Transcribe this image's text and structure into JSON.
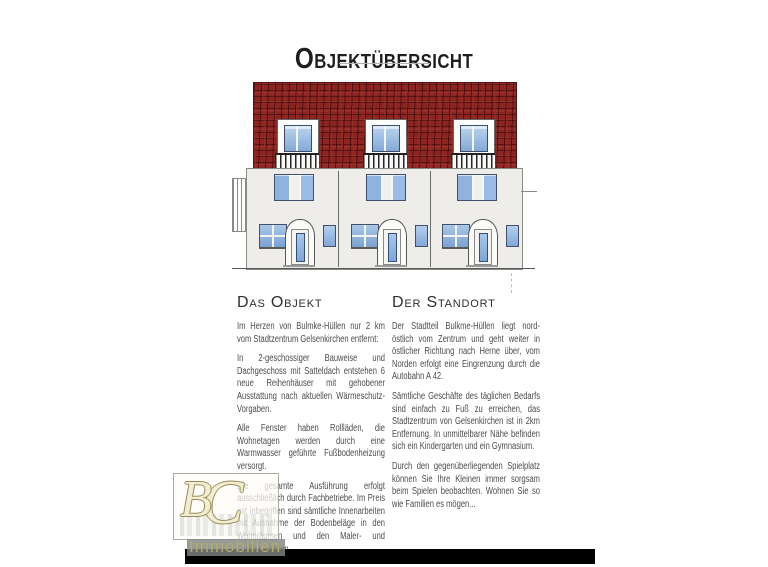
{
  "page": {
    "title": "Objektübersicht"
  },
  "object_section": {
    "heading": "Das Objekt",
    "paragraphs": [
      "Im Herzen von Bulmke-Hüllen nur 2 km vom Stadtzentrum Gelsenkirchen entfernt:",
      "In 2-geschossiger Bauweise und Dachgeschoss mit Satteldach entstehen 6 neue Reihenhäuser mit gehobener Ausstattung nach aktuellen Wärmeschutz-Vorgaben.",
      "Alle Fenster haben Rollläden, die Wohnetagen werden durch eine Warmwasser geführte Fußbodenheizung versorgt.",
      "Die gesamte Ausführung erfolgt ausschließlich durch Fachbetriebe. Im Preis mit inbegriffen sind sämtliche Innenarbeiten mit Ausnahme der Bodenbeläge in den Wohnräumen und den Maler- und Lackierarbeiten."
    ]
  },
  "location_section": {
    "heading": "Der Standort",
    "paragraphs": [
      "Der Stadtteil Bulkme-Hüllen liegt nord-östlich vom Zentrum und geht weiter in östlicher Richtung nach Herne über, vom Norden erfolgt eine Eingrenzung durch die Autobahn A 42.",
      "Sämtliche Geschäfte des täglichen Bedarfs sind einfach zu Fuß zu erreichen, das Stadtzentrum von Gelsenkirchen ist in 2km Entfernung. In unmittelbarer Nähe befinden sich ein Kindergarten und ein Gymnasium.",
      "Durch den gegenüberliegenden Spielplatz können Sie Ihre Kleinen immer sorgsam beim Spielen beobachten. Wohnen Sie so wie Familien es mögen..."
    ]
  },
  "watermark": {
    "monogram_b": "B",
    "monogram_c": "C",
    "label": "Immobilien"
  },
  "colors": {
    "roof_red": "#8c2522",
    "facade_grey": "#eeede9",
    "window_blue": "#8fb2de",
    "logo_gold": "#b3ab68",
    "footer_black": "#000000"
  }
}
